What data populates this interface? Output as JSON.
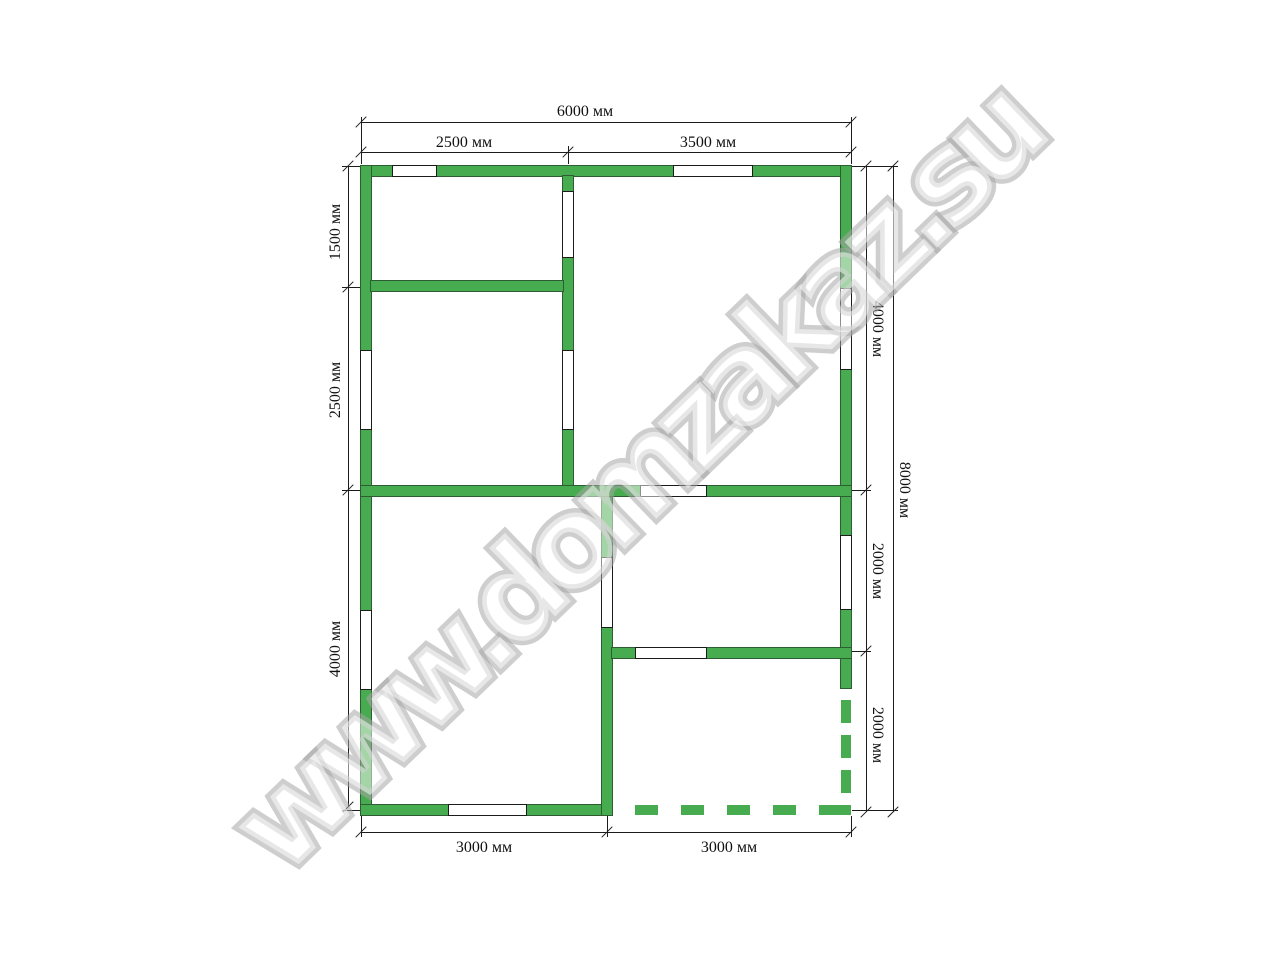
{
  "watermark": {
    "text": "www.domzakaz.su"
  },
  "theme": {
    "wall_green": "#47ab4f",
    "wall_edge": "#2e5c33",
    "line_color": "#1c1c1c",
    "watermark_gray": "#a6a6a6"
  },
  "dims": {
    "width_total": "6000 мм",
    "width_left": "2500 мм",
    "width_right": "3500 мм",
    "height_left_top": "1500 мм",
    "height_left_mid": "2500 мм",
    "height_left_bottom": "4000 мм",
    "height_right_top": "4000 мм",
    "height_right_mid": "2000 мм",
    "height_right_bottom": "2000 мм",
    "height_total": "8000 мм",
    "bottom_left": "3000 мм",
    "bottom_right": "3000 мм"
  }
}
